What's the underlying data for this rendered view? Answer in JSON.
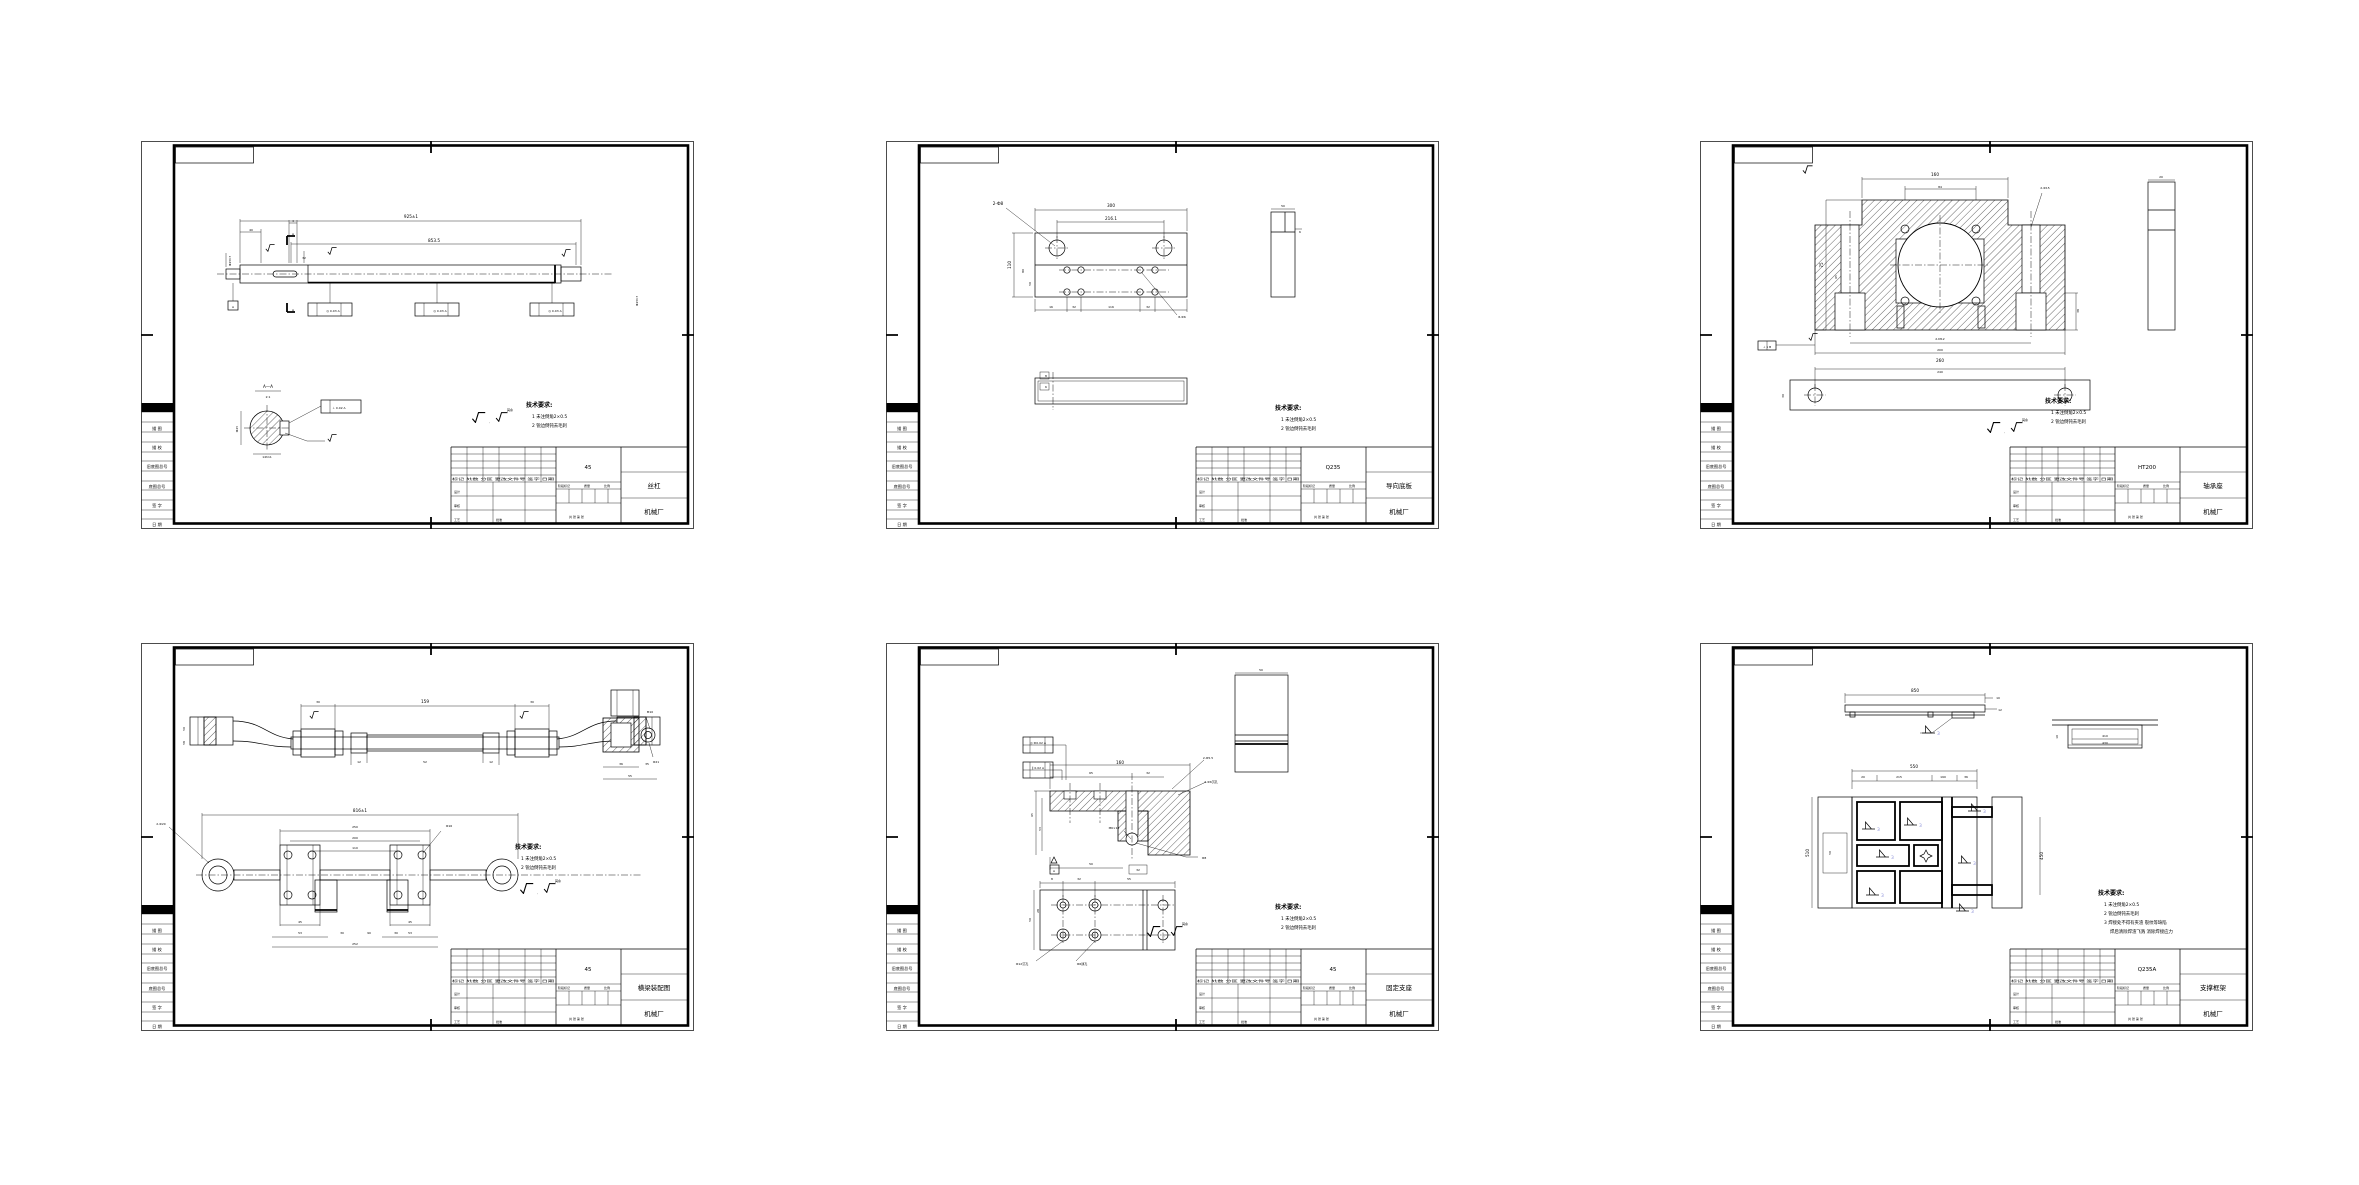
{
  "colors": {
    "line": "#000000",
    "background": "#ffffff",
    "weld_number": "#8a8fd8"
  },
  "shared": {
    "margin_labels": [
      "描 图",
      "描 校",
      "旧底图总号",
      "底图总号",
      "签 字",
      "日 期"
    ],
    "tb": {
      "row": "标记 处数 分区 更改文件号 签字 日期",
      "design": "设计",
      "check": "审核",
      "process": "工艺",
      "approve": "批准",
      "stage": "阶段标记",
      "mass": "质量",
      "scale": "比例",
      "sheets": "共 张 第 张"
    },
    "legend": {
      "comma": ",",
      "rest": "其余"
    }
  },
  "sheets": [
    {
      "name": "丝杠",
      "material": "45",
      "company": "机械厂",
      "notes": {
        "title": "技术要求:",
        "items": [
          "1 未注倒角2×0.5",
          "2 锐边倒钝去毛刺"
        ]
      },
      "dims": [
        {
          "x": 270,
          "y": 77,
          "t": "925±1"
        },
        {
          "x": 293,
          "y": 101,
          "t": "853.5"
        },
        {
          "x": 110,
          "y": 90,
          "t": "40",
          "c": "s3"
        },
        {
          "x": 152,
          "y": 81,
          "t": "4",
          "c": "s3"
        },
        {
          "x": 163,
          "y": 118,
          "t": "32",
          "c": "s3"
        },
        {
          "x": 90,
          "y": 120,
          "t": "Ф25h7",
          "r": -90,
          "c": "s3"
        },
        {
          "x": 497,
          "y": 160,
          "t": "Ф25h7",
          "r": -90,
          "c": "s3"
        },
        {
          "x": 152,
          "y": 94,
          "t": "A",
          "c": "s3"
        },
        {
          "x": 152,
          "y": 170,
          "t": "A",
          "c": "s3"
        },
        {
          "x": 92,
          "y": 167,
          "t": "A",
          "c": "s3"
        },
        {
          "x": 192,
          "y": 171,
          "t": "◎ 0.03 A",
          "c": "s3"
        },
        {
          "x": 299,
          "y": 171,
          "t": "◎ 0.03 A",
          "c": "s3"
        },
        {
          "x": 414,
          "y": 171,
          "t": "◎ 0.03 A",
          "c": "s3"
        },
        {
          "x": 127,
          "y": 247,
          "t": "A—A"
        },
        {
          "x": 127,
          "y": 257,
          "t": "2:1",
          "c": "s3"
        },
        {
          "x": 97,
          "y": 288,
          "t": "Ф25",
          "r": -90,
          "c": "s3"
        },
        {
          "x": 126,
          "y": 317,
          "t": "14h11",
          "c": "s3"
        },
        {
          "x": 198,
          "y": 268,
          "t": "⊥ 0.02 A",
          "c": "s3"
        }
      ]
    },
    {
      "name": "导向底板",
      "material": "Q235",
      "company": "机械厂",
      "notes": {
        "title": "技术要求:",
        "items": [
          "1 未注倒角2×0.5",
          "2 锐边倒钝去毛刺"
        ]
      },
      "dims": [
        {
          "x": 225,
          "y": 66,
          "t": "300"
        },
        {
          "x": 225,
          "y": 79,
          "t": "216.1"
        },
        {
          "x": 125,
          "y": 124,
          "t": "110",
          "r": -90
        },
        {
          "x": 138,
          "y": 130,
          "t": "80",
          "r": -90,
          "c": "s3"
        },
        {
          "x": 145,
          "y": 143,
          "t": "50",
          "r": -90,
          "c": "s3"
        },
        {
          "x": 112,
          "y": 64,
          "t": "2-Ф8"
        },
        {
          "x": 296,
          "y": 177,
          "t": "8-Ф6",
          "c": "s3"
        },
        {
          "x": 165,
          "y": 167,
          "t": "16",
          "c": "s3"
        },
        {
          "x": 188,
          "y": 167,
          "t": "32",
          "c": "s3"
        },
        {
          "x": 225,
          "y": 167,
          "t": "116",
          "c": "s3"
        },
        {
          "x": 262,
          "y": 167,
          "t": "32",
          "c": "s3"
        },
        {
          "x": 397,
          "y": 66,
          "t": "50",
          "c": "s3"
        },
        {
          "x": 414,
          "y": 92,
          "t": "6",
          "c": "s3"
        },
        {
          "x": 160,
          "y": 236,
          "t": "8",
          "c": "s3"
        },
        {
          "x": 160,
          "y": 247,
          "t": "6",
          "c": "s3"
        }
      ]
    },
    {
      "name": "轴承座",
      "material": "HT200",
      "company": "机械厂",
      "notes": {
        "title": "技术要求:",
        "items": [
          "1 未注倒角2×0.5",
          "2 锐边倒钝去毛刺"
        ]
      },
      "dims": [
        {
          "x": 235,
          "y": 35,
          "t": "160"
        },
        {
          "x": 240,
          "y": 47,
          "t": "84",
          "c": "s3"
        },
        {
          "x": 345,
          "y": 48,
          "t": "2-Ф15",
          "c": "s3"
        },
        {
          "x": 123,
          "y": 124,
          "t": "75",
          "r": -90
        },
        {
          "x": 137,
          "y": 136,
          "t": "65",
          "r": -90,
          "c": "s3"
        },
        {
          "x": 379,
          "y": 170,
          "t": "38",
          "r": -90,
          "c": "s3"
        },
        {
          "x": 240,
          "y": 199,
          "t": "2-M12",
          "c": "s3"
        },
        {
          "x": 240,
          "y": 210,
          "t": "200",
          "c": "s3"
        },
        {
          "x": 240,
          "y": 221,
          "t": "260"
        },
        {
          "x": 67,
          "y": 207,
          "t": "⊥ 1 B",
          "c": "s3"
        },
        {
          "x": 461,
          "y": 37,
          "t": "20",
          "c": "s3"
        },
        {
          "x": 240,
          "y": 232,
          "t": "240",
          "c": "s3"
        },
        {
          "x": 84,
          "y": 255,
          "t": "30",
          "r": -90,
          "c": "s3"
        }
      ]
    },
    {
      "name": "横梁装配图",
      "material": "45",
      "company": "机械厂",
      "notes": {
        "title": "技术要求:",
        "items": [
          "1 未注倒角2×0.5",
          "2 锐边倒钝去毛刺"
        ]
      },
      "dims": [
        {
          "x": 177,
          "y": 60,
          "t": "30",
          "c": "s3"
        },
        {
          "x": 284,
          "y": 60,
          "t": "159"
        },
        {
          "x": 391,
          "y": 60,
          "t": "30",
          "c": "s3"
        },
        {
          "x": 44,
          "y": 86,
          "t": "50",
          "r": -90,
          "c": "s3"
        },
        {
          "x": 44,
          "y": 100,
          "t": "58",
          "r": -90,
          "c": "s3"
        },
        {
          "x": 218,
          "y": 120,
          "t": "12",
          "c": "s3"
        },
        {
          "x": 284,
          "y": 120,
          "t": "52",
          "c": "s3"
        },
        {
          "x": 350,
          "y": 120,
          "t": "12",
          "c": "s3"
        },
        {
          "x": 219,
          "y": 169,
          "t": "816±1"
        },
        {
          "x": 214,
          "y": 185,
          "t": "250",
          "c": "s3"
        },
        {
          "x": 214,
          "y": 196,
          "t": "200",
          "c": "s3"
        },
        {
          "x": 214,
          "y": 206,
          "t": "110",
          "c": "s3"
        },
        {
          "x": 20,
          "y": 182,
          "t": "2-Ф20",
          "c": "s3"
        },
        {
          "x": 308,
          "y": 184,
          "t": "Ф16",
          "c": "s3"
        },
        {
          "x": 159,
          "y": 280,
          "t": "45",
          "c": "s3"
        },
        {
          "x": 159,
          "y": 291,
          "t": "53",
          "c": "s3"
        },
        {
          "x": 269,
          "y": 280,
          "t": "45",
          "c": "s3"
        },
        {
          "x": 269,
          "y": 291,
          "t": "53",
          "c": "s3"
        },
        {
          "x": 201,
          "y": 291,
          "t": "30",
          "c": "s3"
        },
        {
          "x": 228,
          "y": 291,
          "t": "90",
          "c": "s3"
        },
        {
          "x": 255,
          "y": 291,
          "t": "30",
          "c": "s3"
        },
        {
          "x": 214,
          "y": 302,
          "t": "252",
          "c": "s3"
        },
        {
          "x": 509,
          "y": 70,
          "t": "M10",
          "c": "s3"
        },
        {
          "x": 515,
          "y": 120,
          "t": "Ф21",
          "c": "s3"
        },
        {
          "x": 480,
          "y": 122,
          "t": "36",
          "c": "s3"
        },
        {
          "x": 506,
          "y": 122,
          "t": "35",
          "c": "s3"
        },
        {
          "x": 489,
          "y": 134,
          "t": "55",
          "c": "s3"
        }
      ]
    },
    {
      "name": "固定支座",
      "material": "45",
      "company": "机械厂",
      "notes": {
        "title": "技术要求:",
        "items": [
          "1 未注倒角2×0.5",
          "2 锐边倒钝去毛刺"
        ]
      },
      "dims": [
        {
          "x": 234,
          "y": 121,
          "t": "160"
        },
        {
          "x": 205,
          "y": 131,
          "t": "65",
          "c": "s3"
        },
        {
          "x": 262,
          "y": 131,
          "t": "32",
          "c": "s3"
        },
        {
          "x": 147,
          "y": 172,
          "t": "65",
          "r": -90,
          "c": "s3"
        },
        {
          "x": 155,
          "y": 186,
          "t": "53",
          "r": -90,
          "c": "s3"
        },
        {
          "x": 205,
          "y": 222,
          "t": "50",
          "c": "s3"
        },
        {
          "x": 252,
          "y": 228,
          "t": "32",
          "c": "s3"
        },
        {
          "x": 228,
          "y": 186,
          "t": "M6×12",
          "c": "s3"
        },
        {
          "x": 322,
          "y": 116,
          "t": "2-Ф5.5",
          "c": "s3"
        },
        {
          "x": 325,
          "y": 140,
          "t": "2-Ф6沉孔",
          "c": "s3"
        },
        {
          "x": 318,
          "y": 216,
          "t": "Ф8",
          "c": "s3"
        },
        {
          "x": 375,
          "y": 28,
          "t": "50",
          "c": "s3"
        },
        {
          "x": 166,
          "y": 237,
          "t": "8",
          "c": "s3"
        },
        {
          "x": 193,
          "y": 237,
          "t": "32",
          "c": "s3"
        },
        {
          "x": 243,
          "y": 237,
          "t": "55",
          "c": "s3"
        },
        {
          "x": 145,
          "y": 277,
          "t": "50",
          "r": -90,
          "c": "s3"
        },
        {
          "x": 153,
          "y": 268,
          "t": "28",
          "r": -90,
          "c": "s3"
        },
        {
          "x": 136,
          "y": 322,
          "t": "Ф12沉孔",
          "c": "s3"
        },
        {
          "x": 196,
          "y": 322,
          "t": "Ф6通孔",
          "c": "s3"
        },
        {
          "x": 168,
          "y": 229,
          "t": "A",
          "c": "s3"
        },
        {
          "x": 152,
          "y": 101,
          "t": "◎ Ф0.02 A",
          "c": "s3"
        },
        {
          "x": 152,
          "y": 126,
          "t": "∥ 0.02 A",
          "c": "s3"
        }
      ]
    },
    {
      "name": "支撑框架",
      "material": "Q235A",
      "company": "机械厂",
      "notes": {
        "title": "技术要求:",
        "items": [
          "1 未注倒角2×0.5",
          "2 锐边倒钝去毛刺",
          "3 焊接处不得有夹渣 裂纹等缺陷",
          "焊后清除焊渣飞溅  消除焊接应力"
        ]
      },
      "welds": {
        "number": "3",
        "points": [
          {
            "x": 162,
            "y": 186
          },
          {
            "x": 204,
            "y": 182
          },
          {
            "x": 268,
            "y": 168
          },
          {
            "x": 176,
            "y": 214
          },
          {
            "x": 258,
            "y": 220
          },
          {
            "x": 166,
            "y": 252
          },
          {
            "x": 256,
            "y": 268
          },
          {
            "x": 222,
            "y": 90
          }
        ]
      },
      "dims": [
        {
          "x": 215,
          "y": 49,
          "t": "850"
        },
        {
          "x": 298,
          "y": 56,
          "t": "10",
          "c": "s3"
        },
        {
          "x": 300,
          "y": 68,
          "t": "12",
          "c": "s3"
        },
        {
          "x": 405,
          "y": 94,
          "t": "410",
          "c": "s3"
        },
        {
          "x": 405,
          "y": 101,
          "t": "430",
          "c": "s3"
        },
        {
          "x": 358,
          "y": 94,
          "t": "10",
          "r": -90,
          "c": "s3"
        },
        {
          "x": 214,
          "y": 125,
          "t": "550"
        },
        {
          "x": 163,
          "y": 135,
          "t": "20",
          "c": "s3"
        },
        {
          "x": 199,
          "y": 135,
          "t": "215",
          "c": "s3"
        },
        {
          "x": 243,
          "y": 135,
          "t": "190",
          "c": "s3"
        },
        {
          "x": 266,
          "y": 135,
          "t": "36",
          "c": "s3"
        },
        {
          "x": 109,
          "y": 210,
          "t": "510",
          "r": -90
        },
        {
          "x": 343,
          "y": 213,
          "t": "450",
          "r": -90
        },
        {
          "x": 131,
          "y": 210,
          "t": "50",
          "r": -90,
          "c": "s3"
        }
      ]
    }
  ]
}
